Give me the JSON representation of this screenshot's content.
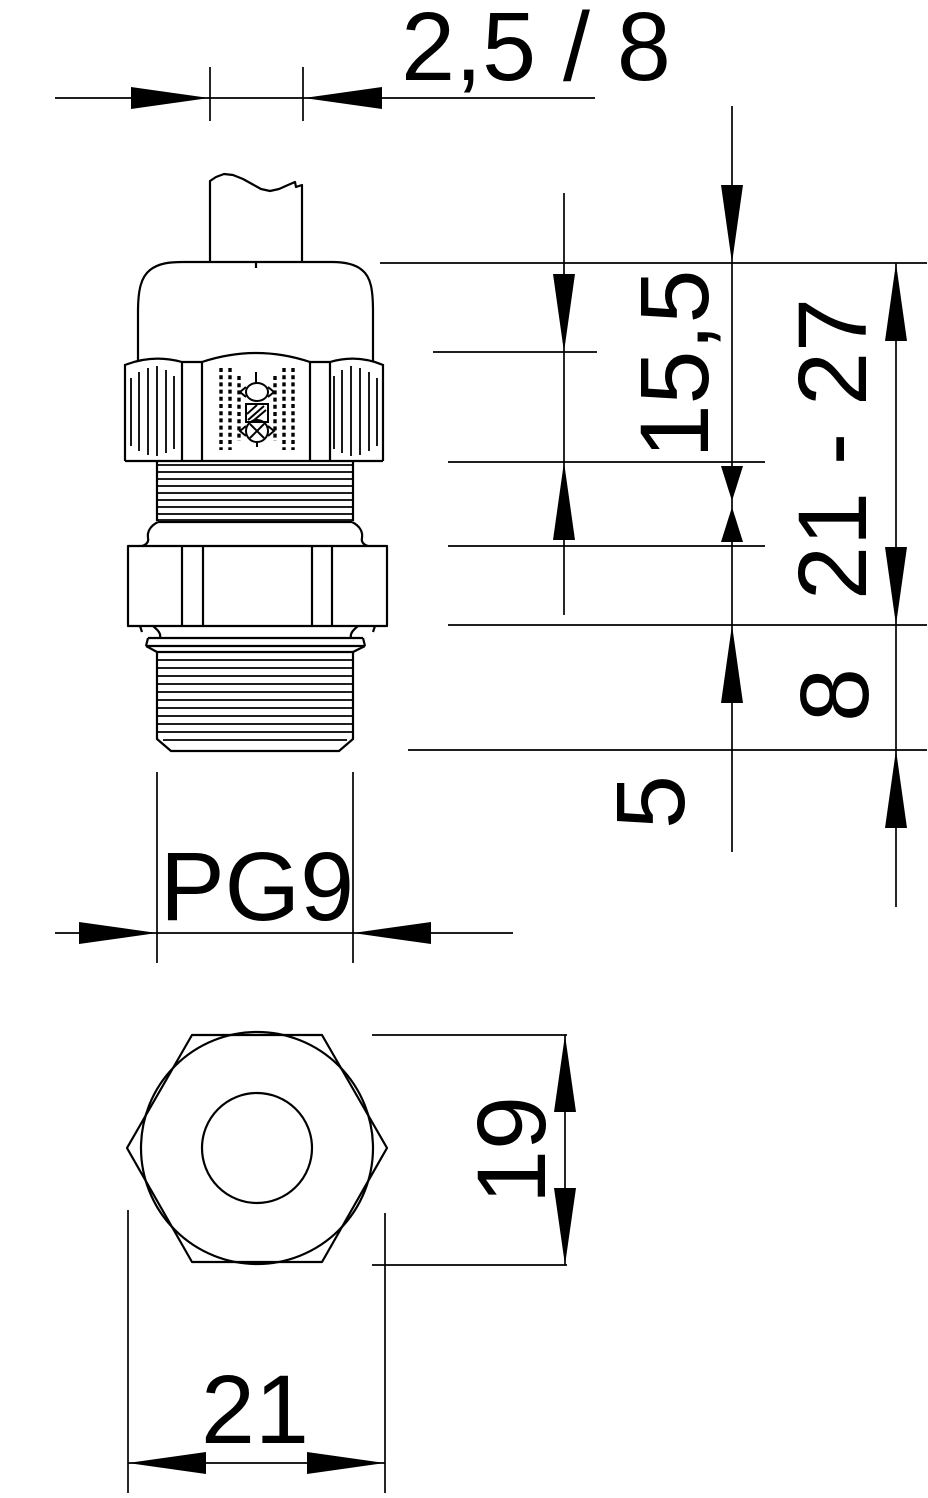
{
  "drawing": {
    "kind": "cable-gland dimensional drawing",
    "colors": {
      "ink": "#000000",
      "paper": "#ffffff"
    },
    "labels": {
      "clamp_range": "2,5 / 8",
      "cap_height": "15,5",
      "overall_height": "21 - 27",
      "thread_length": "8",
      "tip_length": "5",
      "thread_size": "PG9",
      "across_flats": "19",
      "across_corners": "21"
    }
  }
}
